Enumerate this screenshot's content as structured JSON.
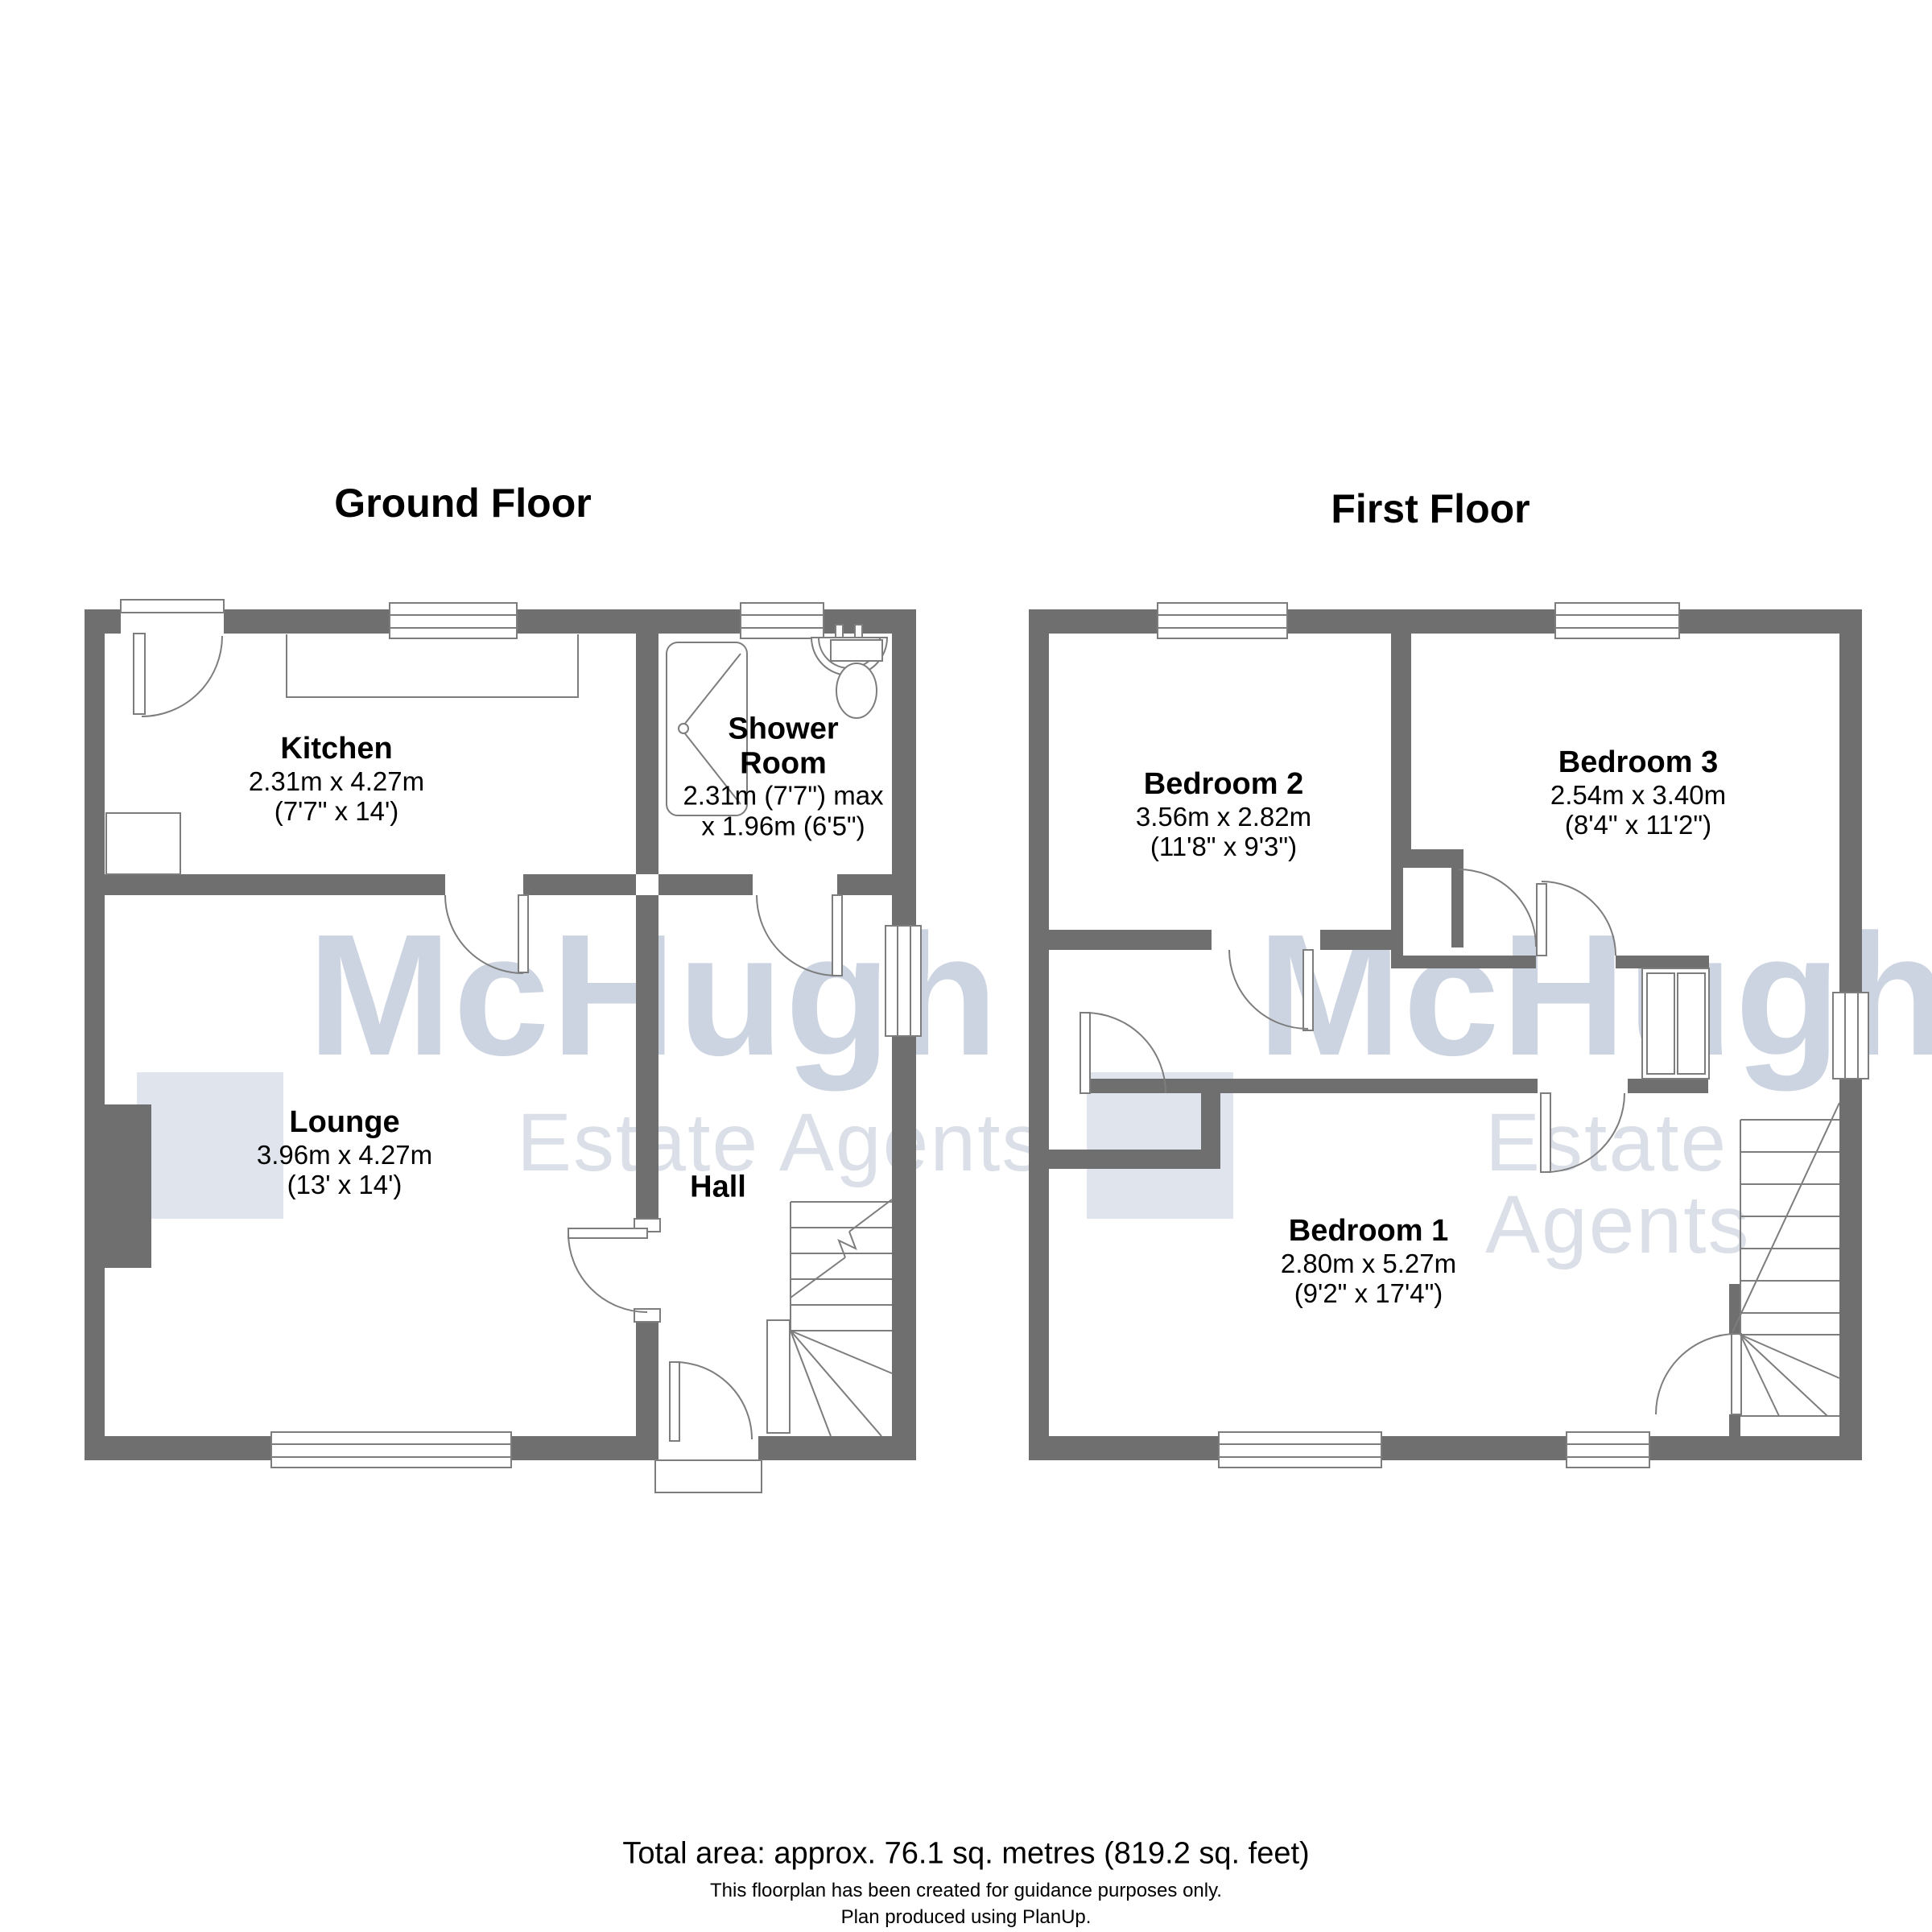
{
  "document": {
    "type": "floorplan",
    "footer": {
      "total_area": "Total area: approx. 76.1 sq. metres (819.2 sq. feet)",
      "disclaimer": "This floorplan has been created for guidance purposes only.",
      "produced": "Plan produced using PlanUp."
    }
  },
  "watermark": {
    "brand": "McHugh",
    "tagline": "Estate Agents"
  },
  "colors": {
    "wall": "#6f6f6f",
    "line": "#7d7d7d",
    "wm-square": "rgba(170,184,208,0.38)",
    "wm-brand": "rgba(136,152,184,0.42)",
    "wm-tagline": "rgba(150,162,188,0.35)"
  },
  "floors": {
    "ground": {
      "title": "Ground Floor",
      "rooms": {
        "kitchen": {
          "name": "Kitchen",
          "dims_metric": "2.31m x 4.27m",
          "dims_imperial": "(7'7\" x 14')"
        },
        "shower": {
          "name": "Shower Room",
          "dims_metric": "2.31m (7'7\") max",
          "dims_imperial": "x 1.96m (6'5\")"
        },
        "lounge": {
          "name": "Lounge",
          "dims_metric": "3.96m x 4.27m",
          "dims_imperial": "(13' x 14')"
        },
        "hall": {
          "name": "Hall"
        }
      }
    },
    "first": {
      "title": "First Floor",
      "rooms": {
        "bedroom2": {
          "name": "Bedroom 2",
          "dims_metric": "3.56m x 2.82m",
          "dims_imperial": "(11'8\" x 9'3\")"
        },
        "bedroom3": {
          "name": "Bedroom 3",
          "dims_metric": "2.54m x 3.40m",
          "dims_imperial": "(8'4\" x 11'2\")"
        },
        "bedroom1": {
          "name": "Bedroom 1",
          "dims_metric": "2.80m x 5.27m",
          "dims_imperial": "(9'2\" x 17'4\")"
        }
      }
    }
  }
}
